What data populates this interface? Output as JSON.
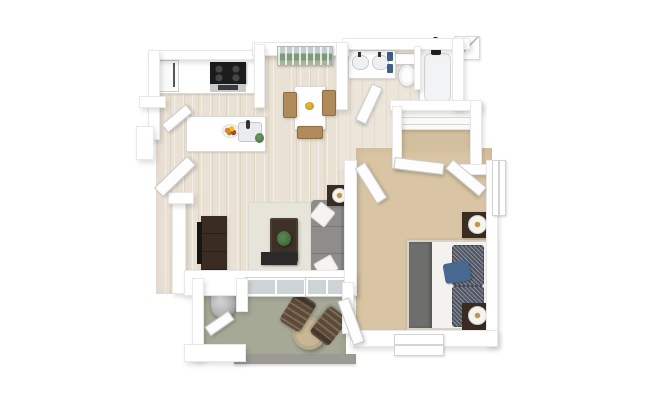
{
  "scene": {
    "title": "3D rendered floor plan of a one-bedroom, one-bathroom apartment with balcony",
    "view": "top-down 3D dollhouse render",
    "background": "#ffffff"
  },
  "palette": {
    "wall": "#ffffff",
    "wood_floor": "#e9e1d3",
    "bath_floor": "#ece6da",
    "carpet_bedroom": "#d9c5a3",
    "carpet_closet": "#d2bf9e",
    "balcony_floor": "#a5a996",
    "balcony_edge": "#9b9b93",
    "rug": "#e7e4da",
    "sofa": "#8f8d8b",
    "sofa_pillow": "#f5f4f0",
    "wood_dark": "#3a2c22",
    "coffee_table": "#3e3026",
    "tv_black": "#161616",
    "bed_mattress": "#f3f2ee",
    "bed_runner": "#6e6e6c",
    "bed_pillow": "#5a6070",
    "bed_accent_pillow": "#48698f",
    "lamp_gold": "#c09a40",
    "dining_chair": "#b18a5c",
    "patio_table": "#c8b696",
    "patio_chair": "#5d4936",
    "plant_green": "#3e6b3f",
    "fruit_orange": "#e0862a",
    "towel_blue": "#3e5f8a",
    "water_heater": "#b9b9b9",
    "appliance_black": "#1c1c1c",
    "appliance_silver": "#c9c9c9",
    "glass": "#ccd4d6"
  },
  "rooms": [
    {
      "name": "Kitchen",
      "floor": "hardwood",
      "items": [
        "refrigerator",
        "range-oven",
        "upper-counter",
        "island-counter",
        "island-sink",
        "faucet",
        "fruit-bowl",
        "small-plant"
      ]
    },
    {
      "name": "Dining Area",
      "floor": "hardwood",
      "items": [
        "dining-table",
        "dining-chair-left",
        "dining-chair-right",
        "dining-chair-bottom",
        "table-bowl",
        "wall-art-landscape"
      ]
    },
    {
      "name": "Living Room",
      "floor": "hardwood",
      "items": [
        "tv-console",
        "tv-panel",
        "area-rug",
        "coffee-table",
        "potted-plant",
        "sofa",
        "throw-pillow-1",
        "throw-pillow-2",
        "side-table",
        "table-lamp",
        "fireplace-media-panel",
        "mantel-candles",
        "window-1",
        "window-2"
      ]
    },
    {
      "name": "Bathroom",
      "floor": "hardwood",
      "items": [
        "double-sink-vanity",
        "sink-left",
        "sink-right",
        "blue-towels",
        "toilet",
        "bathtub",
        "shower-fixture",
        "bathroom-door"
      ]
    },
    {
      "name": "Walk-in Closet",
      "floor": "carpet",
      "items": [
        "shelving-unit",
        "closet-door-left",
        "closet-door-right"
      ]
    },
    {
      "name": "Bedroom",
      "floor": "carpet",
      "items": [
        "bed",
        "gray-foot-runner",
        "speckled-pillows",
        "blue-accent-pillow",
        "nightstand-top",
        "nightstand-bottom",
        "lamp-top",
        "lamp-bottom",
        "side-window",
        "rear-window",
        "bedroom-door",
        "balcony-door"
      ]
    },
    {
      "name": "Balcony",
      "floor": "concrete",
      "items": [
        "bistro-table",
        "patio-chair-1",
        "patio-chair-2",
        "storage-closet",
        "water-heater",
        "storage-door"
      ]
    },
    {
      "name": "Entry",
      "floor": "hardwood",
      "items": [
        "front-door",
        "interior-door"
      ]
    }
  ]
}
